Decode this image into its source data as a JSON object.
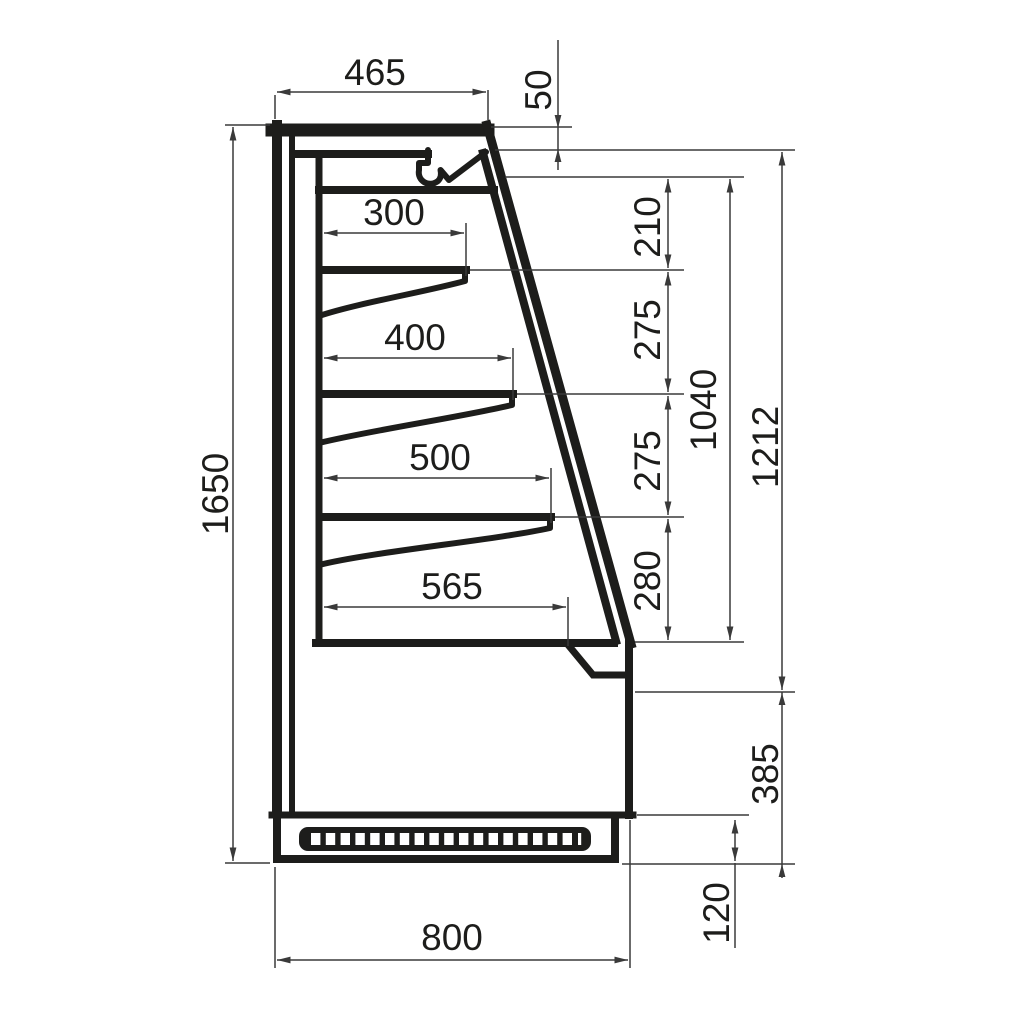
{
  "drawing": {
    "type": "technical-cross-section",
    "subject": "refrigerated-display-cabinet-side-view",
    "line_color": "#1d1d1b",
    "dimension_line_color": "#3a3a3a",
    "background_color": "#ffffff",
    "grille_slots": "19",
    "shelf_count": "3"
  },
  "dims": {
    "top_depth": "465",
    "canopy_front_drop": "50",
    "shelf_1_depth": "300",
    "shelf_2_depth": "400",
    "shelf_3_depth": "500",
    "base_shelf_depth": "565",
    "gap_canopy_to_shelf_1": "210",
    "gap_shelf_1_to_2": "275",
    "gap_shelf_2_to_3": "275",
    "gap_shelf_3_to_deck": "280",
    "display_opening_height": "1040",
    "glass_front_height": "1212",
    "overall_height": "1650",
    "lower_front_height": "385",
    "plinth_height": "120",
    "overall_depth": "800"
  }
}
